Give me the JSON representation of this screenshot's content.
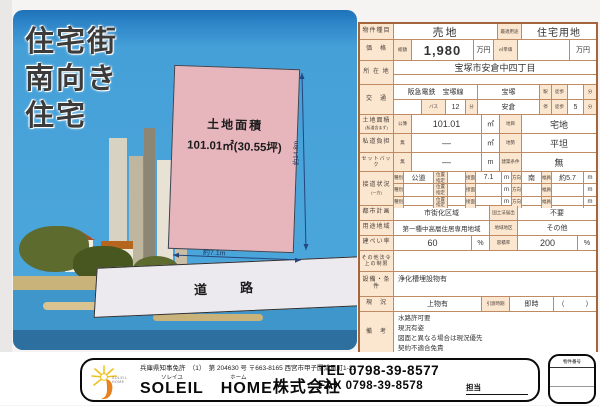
{
  "colors": {
    "table_border": "#c08a62",
    "table_frame": "#a4653c",
    "label_bg": "#fbe6d0",
    "sky": "#45a0d8",
    "sky_dark": "#1f72b8",
    "plot_pink": "#e7b6bd",
    "water": "#3e96cb",
    "water_dark": "#2d6f9e",
    "road_gray": "#eceaee"
  },
  "illustration": {
    "headline1": "住宅街",
    "headline2": "南向き",
    "headline3": "住宅",
    "plot": {
      "title": "土地面積",
      "area": "101.01㎡(30.55坪)",
      "width_label": "約7.1m",
      "depth_label": "約14.8m"
    },
    "road_label": "道　路"
  },
  "table": {
    "r1": {
      "label": "物件種目",
      "value": "売地",
      "label2": "最適用途",
      "value2": "住宅用地"
    },
    "r2": {
      "label": "価　格",
      "sub": "総額",
      "value": "1,980",
      "unit": "万円",
      "label2": "㎡単価",
      "value2": "",
      "unit2": "万円"
    },
    "r3": {
      "label": "所 在 地",
      "value": "宝塚市安倉中四丁目"
    },
    "r4": {
      "label": "交　通",
      "railway": "阪急電鉄　宝塚線",
      "station": "宝塚",
      "sta": "駅",
      "walk": "徒歩",
      "walk_min": "",
      "min": "分",
      "bus": "バス",
      "bus_min": "12",
      "min1": "分",
      "stop": "安倉",
      "stop_sfx": "停",
      "walk2": "徒歩",
      "walk2_min": "5",
      "min2": "分"
    },
    "r5": {
      "label": "土地面積",
      "label_note": "(私道含まず)",
      "sub": "公簿",
      "value": "101.01",
      "unit": "㎡",
      "label2": "地目",
      "value2": "宅地"
    },
    "r6": {
      "label": "私道負担",
      "sub": "無",
      "value": "―",
      "unit": "㎡",
      "label2": "地勢",
      "value2": "平坦"
    },
    "r7": {
      "label": "セットバック",
      "sub": "無",
      "value": "―",
      "unit": "m",
      "label2": "建築条件",
      "value2": "無"
    },
    "r8": {
      "label": "接道状況",
      "label_note": "(一方)",
      "h_type": "種別",
      "h_pos": "位置指定",
      "h_front": "接面",
      "h_dir": "方向",
      "h_width": "幅員",
      "rows": [
        {
          "type": "公道",
          "pos": "",
          "front": "7.1",
          "fu": "m",
          "dir": "南",
          "width": "約5.7",
          "wu": "m"
        },
        {
          "type": "",
          "pos": "",
          "front": "",
          "fu": "m",
          "dir": "",
          "width": "",
          "wu": "m"
        },
        {
          "type": "",
          "pos": "",
          "front": "",
          "fu": "m",
          "dir": "",
          "width": "",
          "wu": "m"
        }
      ]
    },
    "r9": {
      "label": "都市計画",
      "value": "市街化区域",
      "label2": "国土法届出",
      "value2": "不要"
    },
    "r10": {
      "label": "用途地域",
      "value": "第一種中高層住居専用地域",
      "label2": "地域地区",
      "value2": "その他"
    },
    "r11": {
      "label": "建ぺい率",
      "value": "60",
      "unit": "%",
      "label2": "容積率",
      "value2": "200",
      "unit2": "%"
    },
    "r12": {
      "label": "その他法令上の制限",
      "value": ""
    },
    "r13": {
      "label": "設備・条件",
      "value": "浄化槽埋設物有"
    },
    "r14": {
      "label": "現　況",
      "value": "上物有",
      "label2": "引渡時期",
      "value2": "即時",
      "paren": "（　　　）"
    },
    "r15": {
      "label": "備　考",
      "lines": [
        "水路許可要",
        "現況有姿",
        "図面と異なる場合は現況優先",
        "契約不適合免責"
      ]
    }
  },
  "footer": {
    "license": "兵庫県知事免許　（1）　第 204630 号",
    "address": "〒663-8165 西宮市甲子園浦風町1-23",
    "ruby1": "ソレイユ",
    "ruby2": "ホーム",
    "company1": "SOLEIL",
    "company2": "　HOME",
    "company3": "株式会社",
    "tel_label": "TEL ",
    "tel": "0798-39-8577",
    "fax_label": "FAX ",
    "fax": "0798-39-8578",
    "staff": "担当",
    "stamp": "物件番号",
    "logo_text": "SOLEIL HOME"
  }
}
